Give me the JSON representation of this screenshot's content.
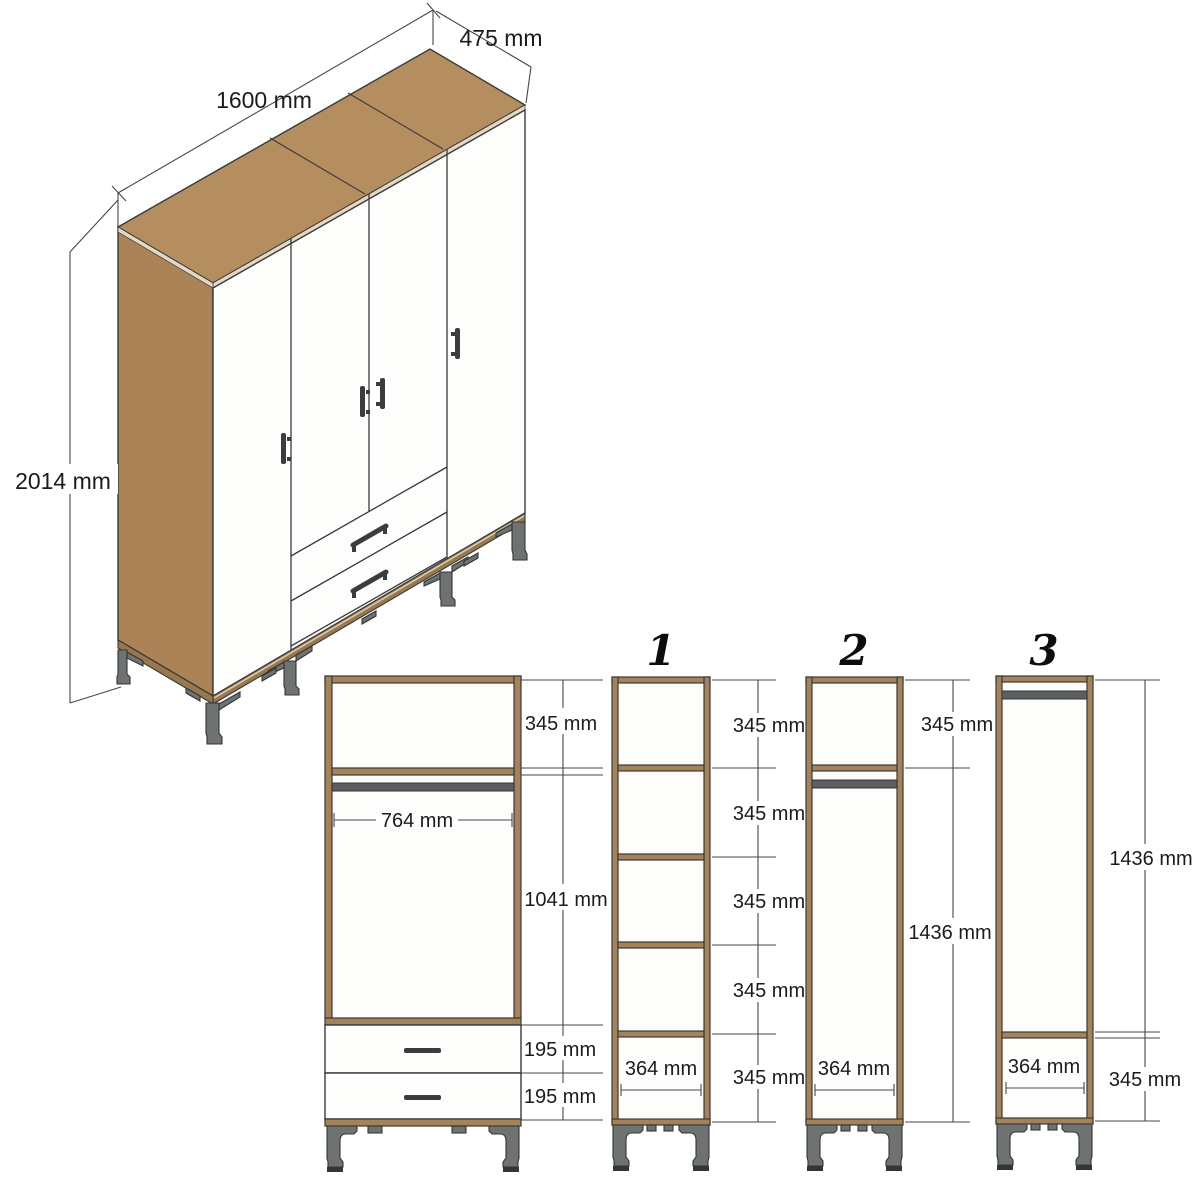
{
  "colors": {
    "wood_top": "#b58e60",
    "wood_side": "#ab8356",
    "wood_frame": "#a3825c",
    "rail": "#997850",
    "edge_light": "#e4d8c2",
    "door": "#fdfdfc",
    "metal": "#6e7271",
    "metal_dark": "#343635",
    "rod": "#5c5f61",
    "handle": "#393d40",
    "outline": "#3a3a3a",
    "dim": "#474747"
  },
  "iso_view": {
    "width_label": "1600 mm",
    "depth_label": "475 mm",
    "height_label": "2014 mm"
  },
  "front_view": {
    "top_compartment": "345 mm",
    "hanging_width": "764 mm",
    "hanging_height": "1041 mm",
    "drawer_upper": "195 mm",
    "drawer_lower": "195 mm"
  },
  "sections": [
    {
      "label": "1",
      "compartments": [
        "345 mm",
        "345 mm",
        "345 mm",
        "345 mm",
        "345 mm"
      ],
      "width": "364 mm"
    },
    {
      "label": "2",
      "top_compartment": "345 mm",
      "hanging_height": "1436 mm",
      "width": "364 mm"
    },
    {
      "label": "3",
      "hanging_height": "1436 mm",
      "bottom_compartment": "345 mm",
      "width": "364 mm"
    }
  ]
}
